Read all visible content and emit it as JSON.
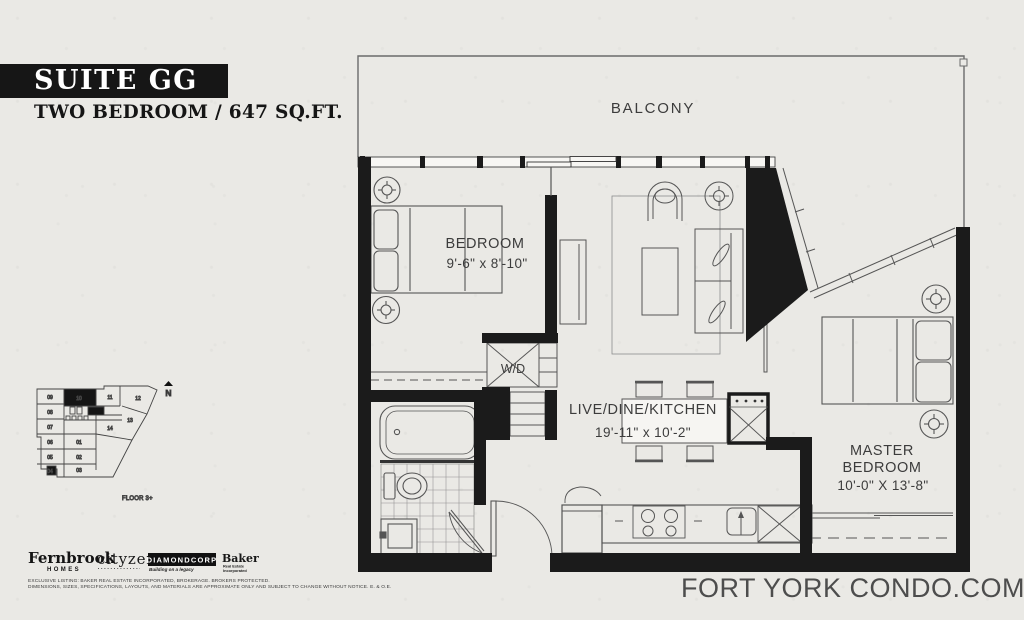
{
  "header": {
    "bar_label": "SUITE GG",
    "subtitle": "TWO BEDROOM / 647 SQ.FT."
  },
  "floorplan": {
    "balcony_label": "BALCONY",
    "bedroom": {
      "name": "BEDROOM",
      "dims": "9'-6\" x 8'-10\""
    },
    "living": {
      "name": "LIVE/DINE/KITCHEN",
      "dims": "19'-11\" x 10'-2\""
    },
    "master": {
      "line1": "MASTER",
      "line2": "BEDROOM",
      "dims": "10'-0\" X 13'-8\""
    },
    "washer_dryer_label": "W/D",
    "colors": {
      "wall": "#1b1b1b",
      "paper": "#eae9e5",
      "line": "#555555"
    }
  },
  "keyplan": {
    "floor_label": "FLOOR 3+",
    "north_label": "N",
    "highlighted_unit": "10",
    "units": [
      "09",
      "10",
      "11",
      "12",
      "08",
      "13",
      "07",
      "14",
      "06",
      "01",
      "05",
      "02",
      "04",
      "03"
    ]
  },
  "footer": {
    "logos": {
      "fernbrook": {
        "name": "Fernbrook",
        "sub": "HOMES"
      },
      "cityzen": {
        "name": "cityzen"
      },
      "diamondcorp": {
        "name": "DIAMONDCORP",
        "sub": "Building on a legacy"
      },
      "baker": {
        "name": "Baker",
        "sub1": "Real Estate",
        "sub2": "Incorporated"
      }
    },
    "disclaimer_line1": "EXCLUSIVE LISTING: BAKER REAL ESTATE INCORPORATED, BROKERAGE. BROKERS PROTECTED.",
    "disclaimer_line2": "DIMENSIONS, SIZES, SPECIFICATIONS, LAYOUTS, AND MATERIALS ARE APPROXIMATE ONLY AND SUBJECT TO CHANGE WITHOUT NOTICE. E. & O.E.",
    "website": "FORT YORK CONDO.COM"
  }
}
